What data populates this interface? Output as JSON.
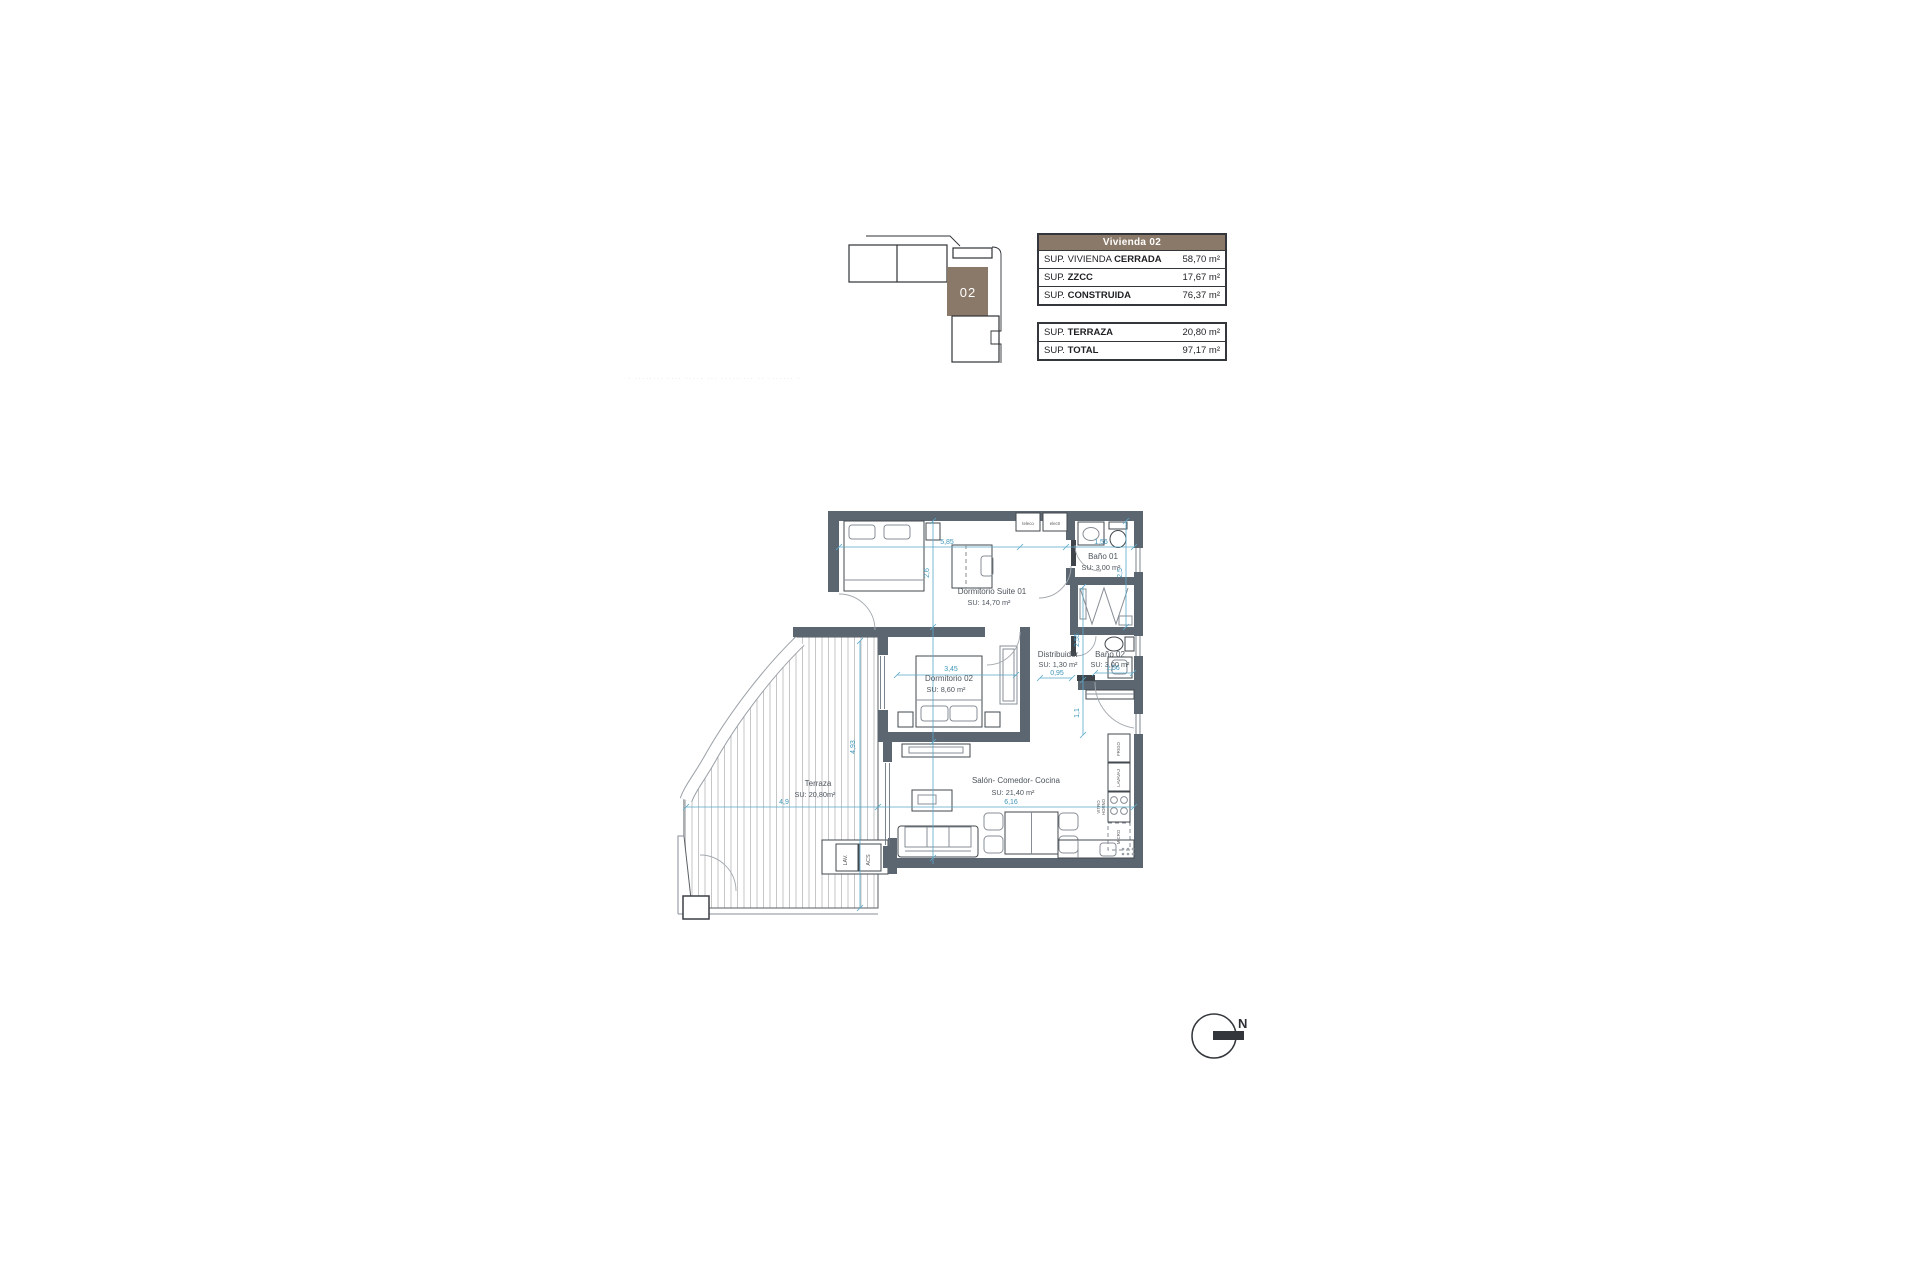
{
  "colors": {
    "wall": "#5c6670",
    "dim": "#5aa8c8",
    "dimtext": "#3e96ba",
    "label": "#4c545c",
    "brown": "#8a7968"
  },
  "key_plan": {
    "unit": "02"
  },
  "tables": {
    "header": "Vivienda 02",
    "rows": [
      {
        "prefix": "SUP. VIVIENDA ",
        "label": "CERRADA",
        "value": "58,70 m²"
      },
      {
        "prefix": "SUP. ",
        "label": "ZZCC",
        "value": "17,67 m²"
      },
      {
        "prefix": "SUP. ",
        "label": "CONSTRUIDA",
        "value": "76,37 m²"
      }
    ],
    "rows2": [
      {
        "prefix": "SUP. ",
        "label": "TERRAZA",
        "value": "20,80 m²"
      },
      {
        "prefix": "SUP. ",
        "label": "TOTAL",
        "value": "97,17 m²"
      }
    ]
  },
  "fine_print": "· ········ ···· ····· ··· ········· ·· ······· · ·····",
  "rooms": {
    "suite": {
      "name": "Dormitorio Suite  01",
      "area": "SU: 14,70 m²"
    },
    "bano1": {
      "name": "Baño 01",
      "area": "SU: 3,00 m²"
    },
    "distribuidor": {
      "name": "Distribuidor",
      "area": "SU: 1,30 m²"
    },
    "bano2": {
      "name": "Baño 02",
      "area": "SU: 3,00 m²"
    },
    "dorm2": {
      "name": "Dormitorio 02",
      "area": "SU: 8,60 m²"
    },
    "salon": {
      "name": "Salón- Comedor- Cocina",
      "area": "SU: 21,40 m²"
    },
    "terraza": {
      "name": "Terraza",
      "area": "SU: 20,80m²"
    }
  },
  "dimensions": {
    "d585": "5,85",
    "d156a": "1,56",
    "d26": "2,6",
    "d25": "2,5",
    "d255": "2,55",
    "d11": "1,1",
    "d345": "3,45",
    "d095": "0,95",
    "d156b": "1,56",
    "d49": "4,9",
    "d616": "6,16",
    "d493": "4,93"
  },
  "appliances": {
    "frigo": "FRIGO",
    "lavavaj": "LAVAVAJ",
    "vitro1": "VITRO",
    "vitro2": "HORNO",
    "micro": "MICRO",
    "lav": "LAV.",
    "acs": "ACS",
    "teleco": "teleco",
    "electr": "electr"
  },
  "compass": {
    "label": "N"
  }
}
